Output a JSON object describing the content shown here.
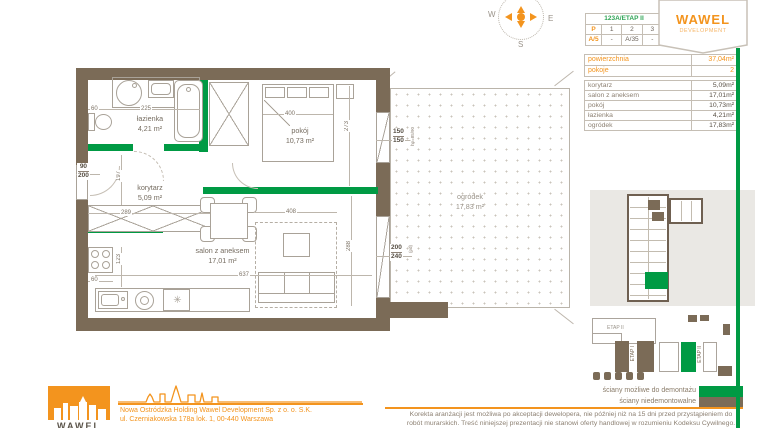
{
  "colors": {
    "accent_green": "#009a44",
    "wall_brown": "#7b6b57",
    "brand_orange": "#f3941e"
  },
  "compass": {
    "west": "W",
    "east": "E",
    "south": "S"
  },
  "unit_table": {
    "title": "123A/ETAP II",
    "rows": [
      [
        "P",
        "1",
        "2",
        "3"
      ],
      [
        "A/5",
        "-",
        "A/35",
        "-"
      ]
    ]
  },
  "brand_badge": {
    "name": "WAWEL",
    "subtitle": "DEVELOPMENT"
  },
  "summary_table": {
    "rows": [
      {
        "label": "powierzchnia",
        "value": "37,04m²"
      },
      {
        "label": "pokoje",
        "value": "2"
      }
    ]
  },
  "rooms_table": {
    "rows": [
      {
        "label": "korytarz",
        "value": "5,09m²"
      },
      {
        "label": "salon z aneksem",
        "value": "17,01m²"
      },
      {
        "label": "pokój",
        "value": "10,73m²"
      },
      {
        "label": "łazienka",
        "value": "4,21m²"
      },
      {
        "label": "ogródek",
        "value": "17,83m²"
      }
    ]
  },
  "plan": {
    "rooms": {
      "lazienka": {
        "name": "łazienka",
        "area": "4,21 m²"
      },
      "korytarz": {
        "name": "korytarz",
        "area": "5,09 m²"
      },
      "pokoj": {
        "name": "pokój",
        "area": "10,73 m²"
      },
      "salon": {
        "name": "salon z aneksem",
        "area": "17,01 m²"
      },
      "ogrodek": {
        "name": "ogródek",
        "area": "17,83 m²"
      }
    },
    "dims": {
      "toilet_width": "60",
      "bath_width": "225",
      "entry_door": {
        "w": "90",
        "h": "200"
      },
      "hall_length": "197",
      "wardrobe_width": "289",
      "kitchen_depth": "123",
      "kitchen_width": "60",
      "salon_width": "637",
      "bed_width": "400",
      "room_depth": "273",
      "carpet_width": "408",
      "salon_depth": "288",
      "window1": {
        "w": "150",
        "h": "150",
        "note": "hp=85/90"
      },
      "window2": {
        "w": "200",
        "h": "240",
        "note": "(pd)"
      }
    },
    "icons": {
      "dishwasher": "✳"
    }
  },
  "site_plan": {
    "outline_label": "ETAP II",
    "building_left_label": "ETAP I",
    "building_right_label": "ETAP II"
  },
  "legend": {
    "items": [
      {
        "label": "ściany możliwe do demontażu",
        "color": "#009a44"
      },
      {
        "label": "ściany niedemontowalne",
        "color": "#7b6b57"
      }
    ]
  },
  "disclaimer": {
    "line1": "Korekta aranżacji jest możliwa po akceptacji dewelopera, nie później niż na 15 dni przed przystąpieniem do",
    "line2": "robót murarskich. Treść niniejszej prezentacji nie stanowi oferty handlowej w rozumieniu Kodeksu Cywilnego."
  },
  "footer": {
    "logo_text": "WAWEL",
    "company_line1": "Nowa Ostródzka Holding Wawel Development Sp. z o. o. S.K.",
    "company_line2": "ul. Czerniakowska 178a lok. 1, 00-440 Warszawa"
  }
}
